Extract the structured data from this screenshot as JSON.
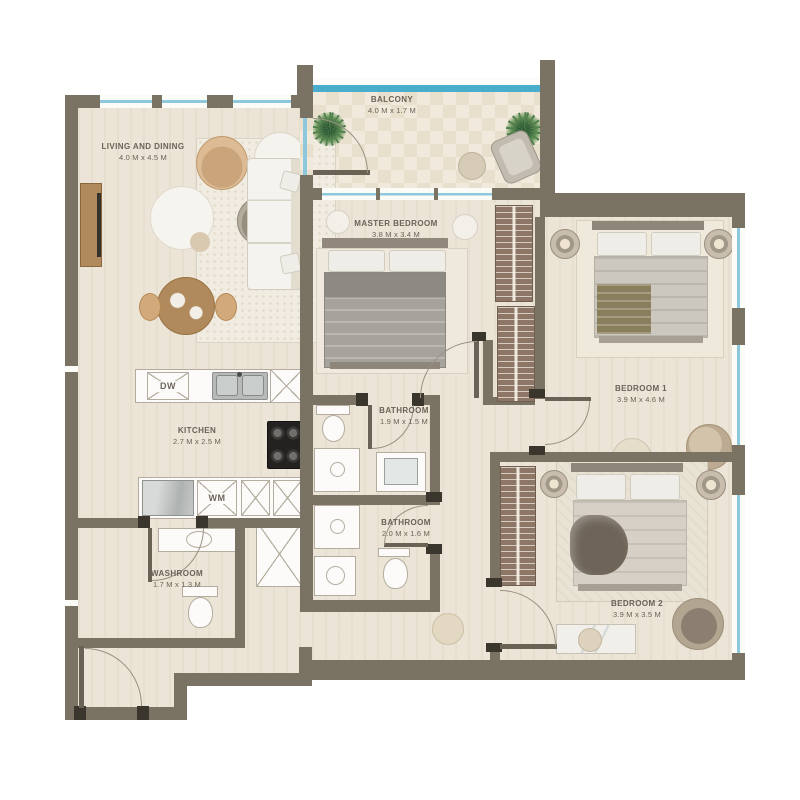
{
  "rooms": {
    "living": {
      "name": "LIVING AND DINING",
      "dims": "4.0 M  x 4.5 M"
    },
    "balcony": {
      "name": "BALCONY",
      "dims": "4.0 M  x 1.7 M"
    },
    "master": {
      "name": "MASTER BEDROOM",
      "dims": "3.8 M  x 3.4 M"
    },
    "bedroom1": {
      "name": "BEDROOM 1",
      "dims": "3.9 M  x 4.6 M"
    },
    "bedroom2": {
      "name": "BEDROOM 2",
      "dims": "3.9 M  x 3.5 M"
    },
    "kitchen": {
      "name": "KITCHEN",
      "dims": "2.7 M  x 2.5 M"
    },
    "bathroom1": {
      "name": "BATHROOM",
      "dims": "1.9 M  x 1.5 M"
    },
    "bathroom2": {
      "name": "BATHROOM",
      "dims": "2.0 M  x 1.6 M"
    },
    "washroom": {
      "name": "WASHROOM",
      "dims": "1.7 M  x 1.3 M"
    }
  },
  "appliances": {
    "dishwasher": "DW",
    "washer": "WM"
  },
  "colors": {
    "wall": "#7a7263",
    "floor": "#ece4d6",
    "floor2": "#e9dfcd",
    "glass": "#8ec8dc",
    "glass2": "#49aecb",
    "wood": "#b08a5c",
    "wood2": "#8d7666",
    "text": "#6b6257",
    "dark": "#3a352d",
    "line": "#b4ad9f"
  }
}
